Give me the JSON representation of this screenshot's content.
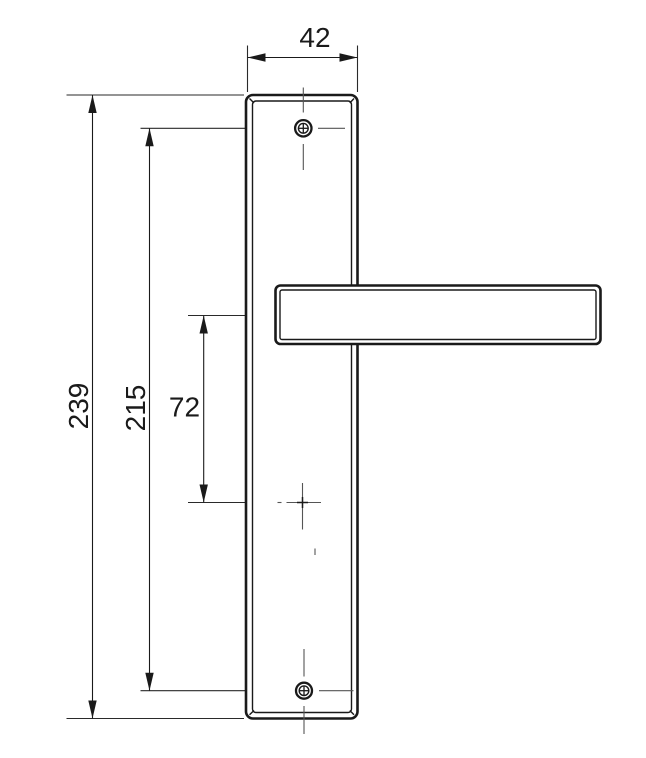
{
  "drawing": {
    "type": "technical-dimension-drawing",
    "subject": "door-handle-with-long-backplate-front-view",
    "dims": {
      "plate_width": {
        "value": "42"
      },
      "plate_height": {
        "value": "239"
      },
      "screw_spacing": {
        "value": "215"
      },
      "handle_to_spindle": {
        "value": "72"
      }
    },
    "colors": {
      "line": "#1a1a1a",
      "centerline": "#555555",
      "background": "#ffffff"
    }
  }
}
